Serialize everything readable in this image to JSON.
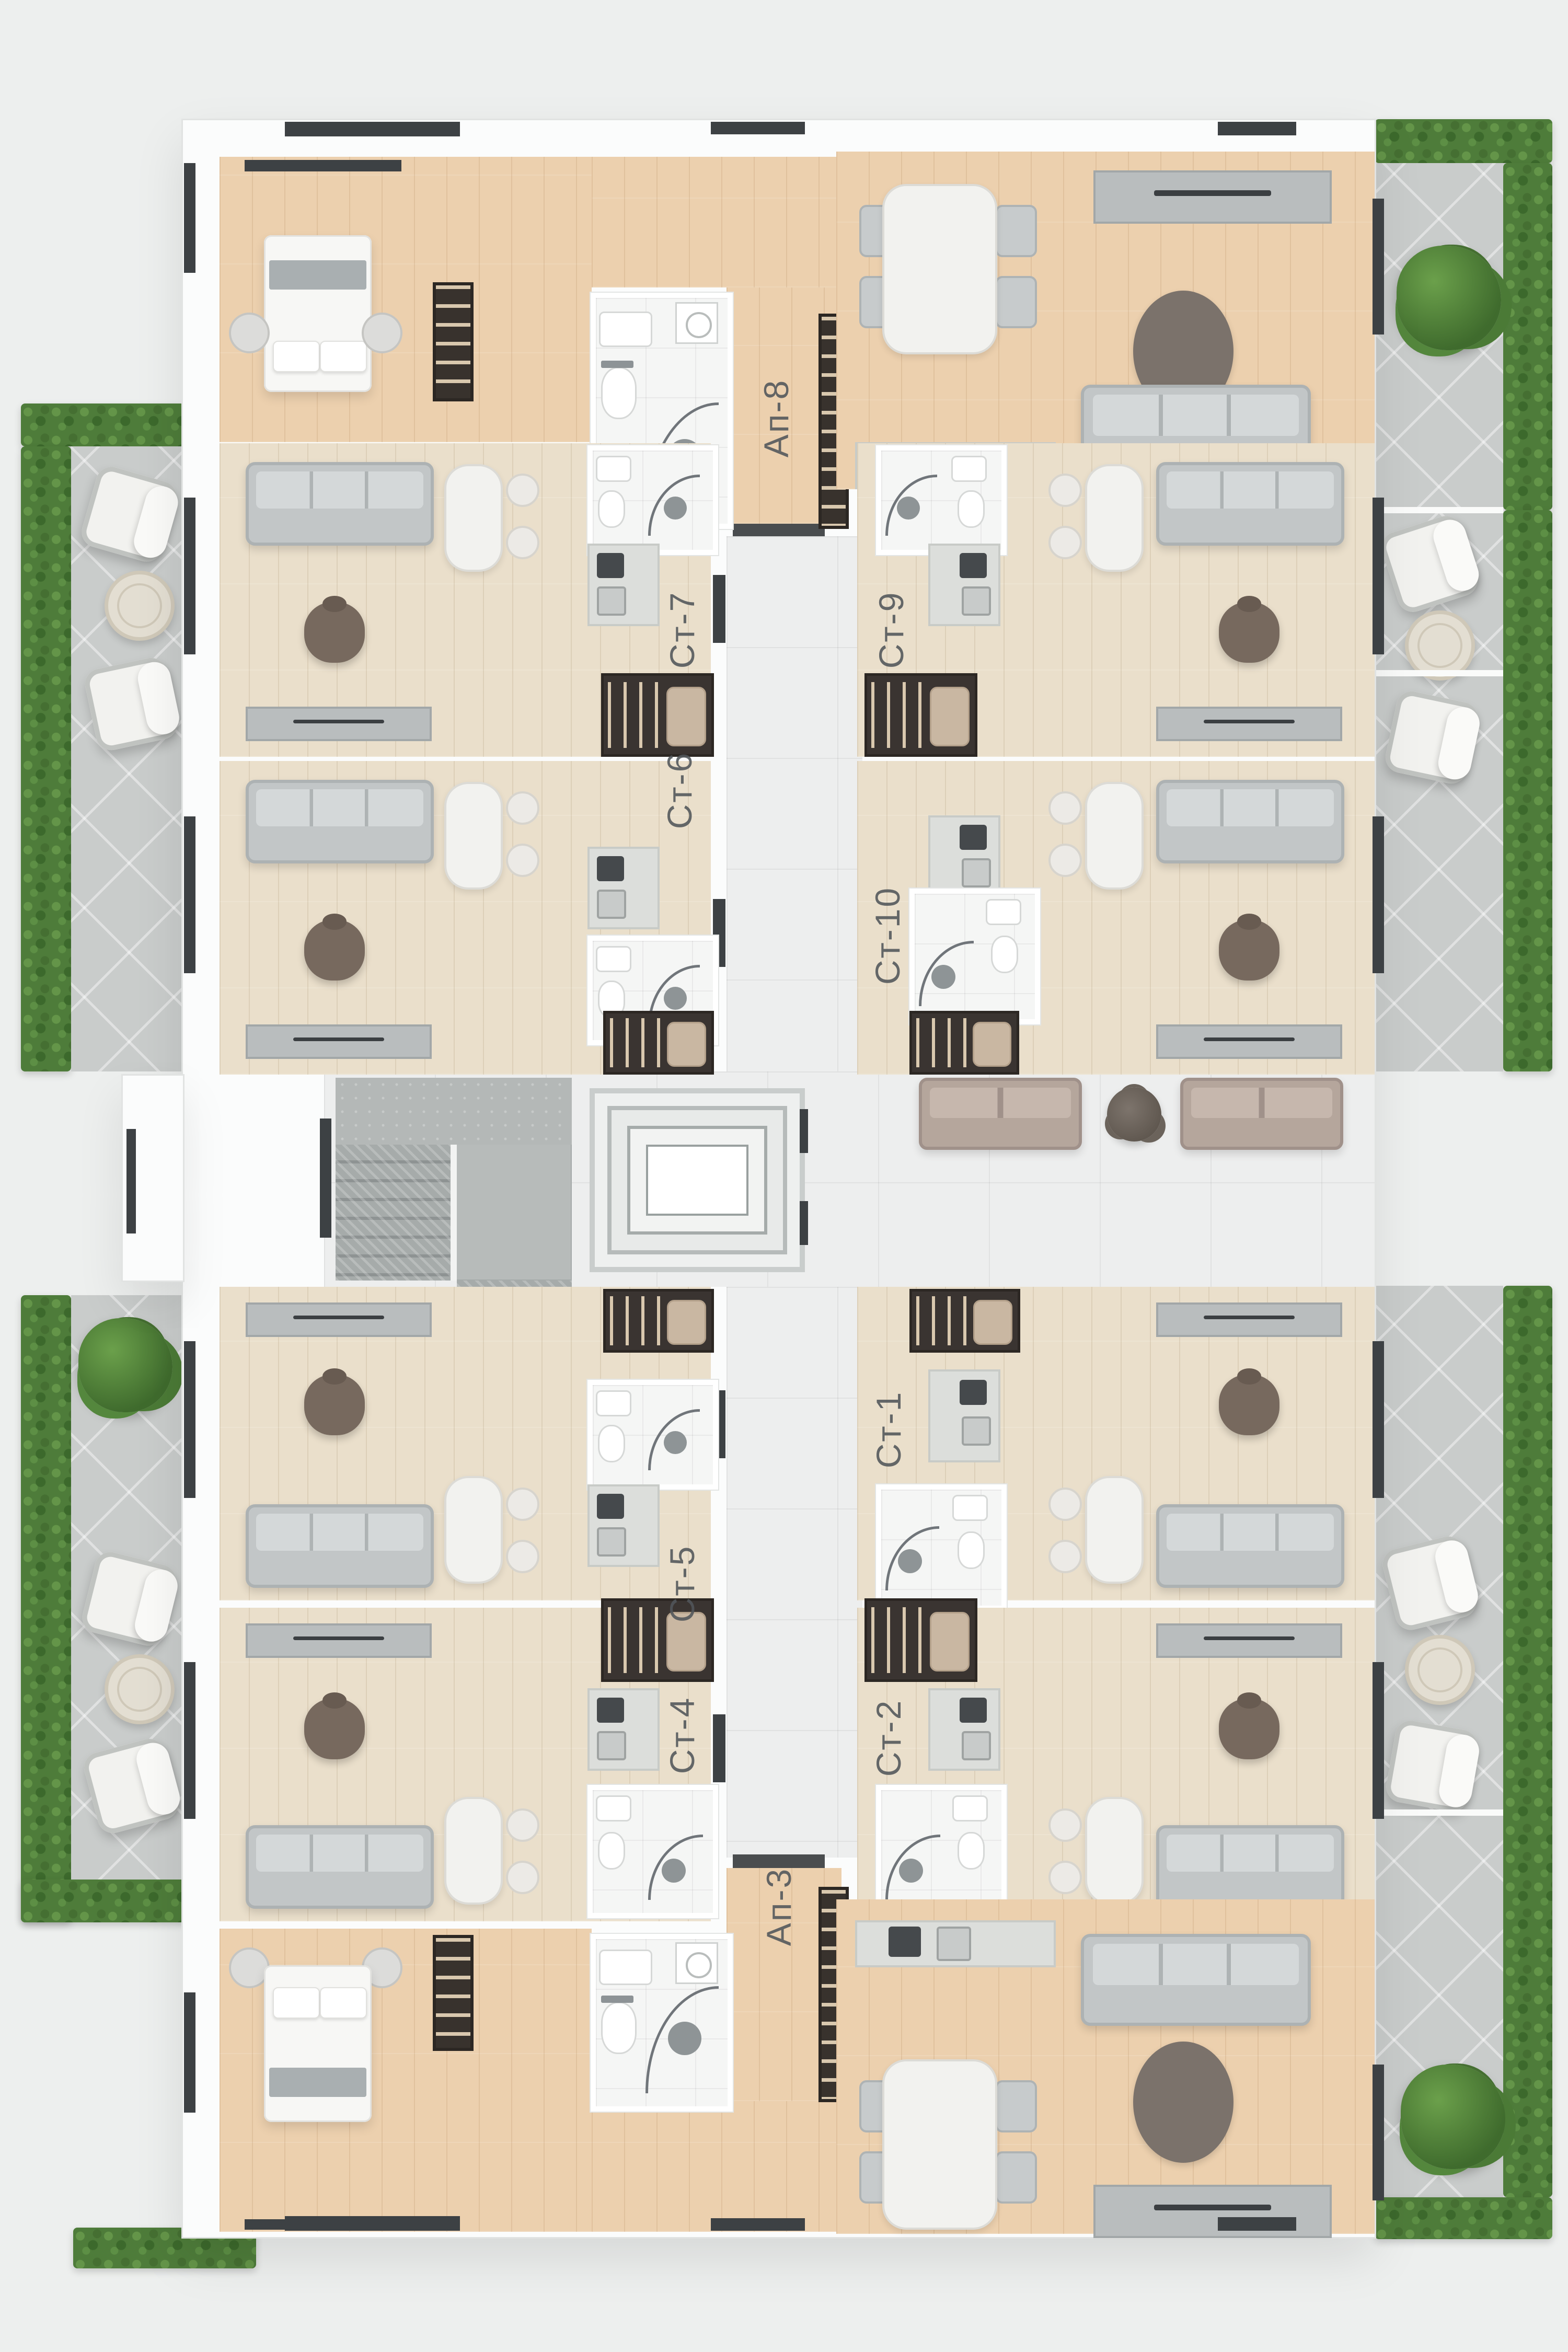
{
  "plan": {
    "type": "residential-floor-plan",
    "units": [
      {
        "id": "ap-8",
        "label": "Ап-8"
      },
      {
        "id": "st-7",
        "label": "Ст-7"
      },
      {
        "id": "st-9",
        "label": "Ст-9"
      },
      {
        "id": "st-6",
        "label": "Ст-6"
      },
      {
        "id": "st-10",
        "label": "Ст-10"
      },
      {
        "id": "st-5",
        "label": "Ст-5"
      },
      {
        "id": "st-1",
        "label": "Ст-1"
      },
      {
        "id": "st-4",
        "label": "Ст-4"
      },
      {
        "id": "st-2",
        "label": "Ст-2"
      },
      {
        "id": "ap-3",
        "label": "Ап-3"
      }
    ],
    "palette": {
      "background": "#edefee",
      "wall_white": "#fbfcfc",
      "wood_warm": "#ecd0ae",
      "wood_light": "#eadfcb",
      "corridor_tile": "#edeeee",
      "terrace_tile": "#c9cccb",
      "hedge_green": "#4e7c3a",
      "window_dark": "#3d4144",
      "sofa_gray": "#c2c6c7",
      "sofa_taupe": "#b5a69c",
      "furniture_dark": "#77695e",
      "label_text": "#51565a"
    }
  }
}
